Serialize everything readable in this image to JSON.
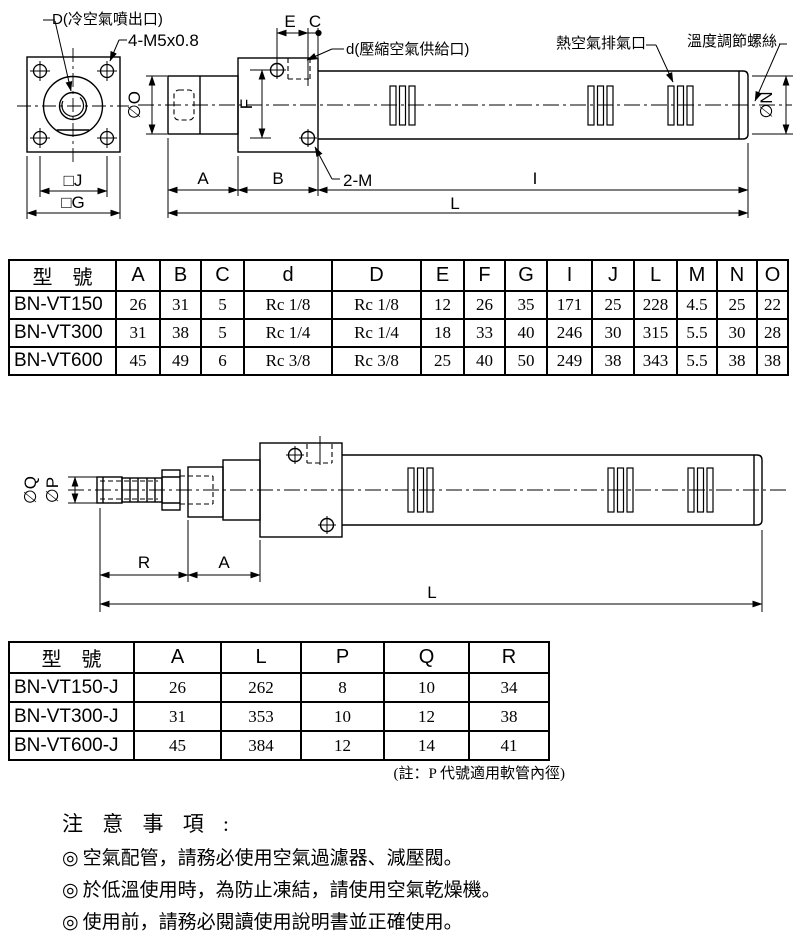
{
  "drawing1": {
    "labels": {
      "cold_air_outlet": "D(冷空氣噴出口)",
      "bolt_spec": "4-M5x0.8",
      "dim_e": "E",
      "dim_c": "C",
      "air_supply": "d(壓縮空氣供給口)",
      "hot_air_exhaust": "熱空氣排氣口",
      "temp_screw": "溫度調節螺絲",
      "dia_o": "∅O",
      "dia_n": "∅N",
      "dim_f": "F",
      "thread_2m": "2-M",
      "sq_j": "□J",
      "sq_g": "□G",
      "dim_a": "A",
      "dim_b": "B",
      "dim_i": "I",
      "dim_l": "L"
    }
  },
  "table1": {
    "headers": [
      "型　號",
      "A",
      "B",
      "C",
      "d",
      "D",
      "E",
      "F",
      "G",
      "I",
      "J",
      "L",
      "M",
      "N",
      "O"
    ],
    "rows": [
      [
        "BN-VT150",
        "26",
        "31",
        "5",
        "Rc 1/8",
        "Rc 1/8",
        "12",
        "26",
        "35",
        "171",
        "25",
        "228",
        "4.5",
        "25",
        "22"
      ],
      [
        "BN-VT300",
        "31",
        "38",
        "5",
        "Rc 1/4",
        "Rc 1/4",
        "18",
        "33",
        "40",
        "246",
        "30",
        "315",
        "5.5",
        "30",
        "28"
      ],
      [
        "BN-VT600",
        "45",
        "49",
        "6",
        "Rc 3/8",
        "Rc 3/8",
        "25",
        "40",
        "50",
        "249",
        "38",
        "343",
        "5.5",
        "38",
        "38"
      ]
    ]
  },
  "drawing2": {
    "labels": {
      "dia_q": "∅Q",
      "dia_p": "∅P",
      "dim_r": "R",
      "dim_a": "A",
      "dim_l": "L"
    }
  },
  "table2": {
    "headers": [
      "型　號",
      "A",
      "L",
      "P",
      "Q",
      "R"
    ],
    "rows": [
      [
        "BN-VT150-J",
        "26",
        "262",
        "8",
        "10",
        "34"
      ],
      [
        "BN-VT300-J",
        "31",
        "353",
        "10",
        "12",
        "38"
      ],
      [
        "BN-VT600-J",
        "45",
        "384",
        "12",
        "14",
        "41"
      ]
    ],
    "note": "(註：P 代號適用軟管內徑)"
  },
  "notes": {
    "title": "注 意 事 項 :",
    "bullet": "◎",
    "items": [
      "空氣配管，請務必使用空氣過濾器、減壓閥。",
      "於低溫使用時，為防止凍結，請使用空氣乾燥機。",
      "使用前，請務必閱讀使用說明書並正確使用。"
    ]
  }
}
